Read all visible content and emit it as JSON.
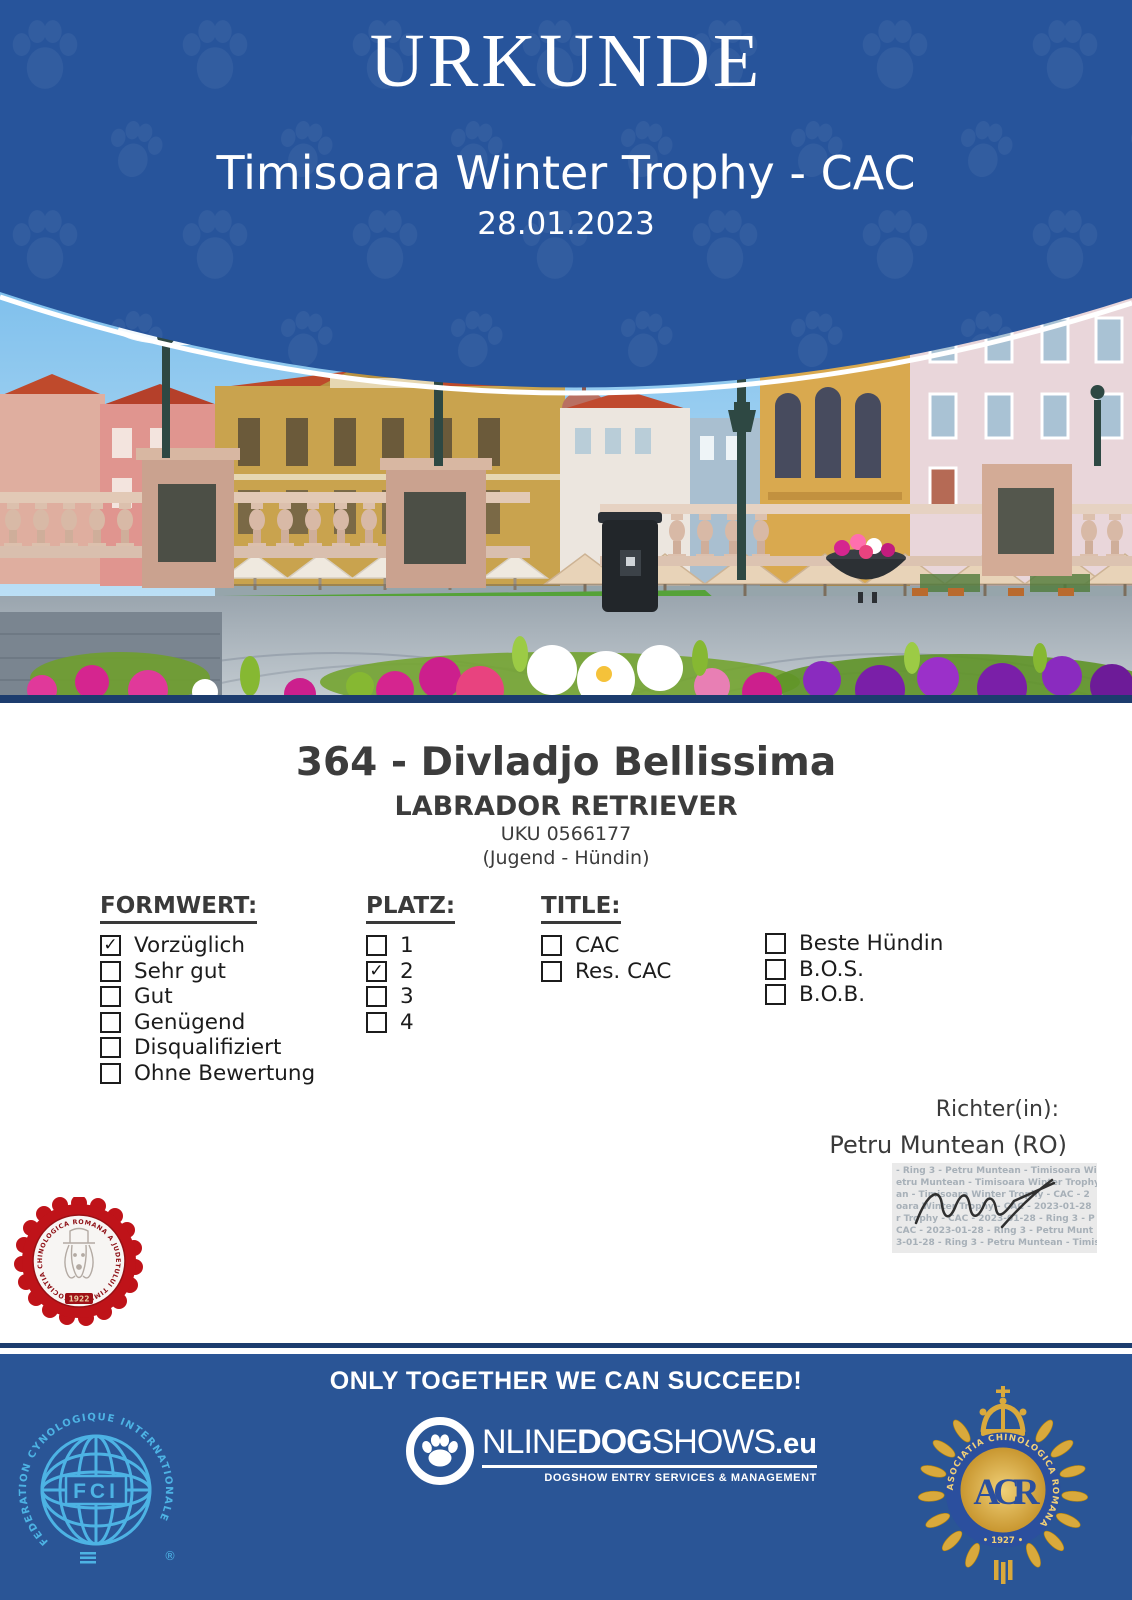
{
  "header": {
    "title": "URKUNDE",
    "event": "Timisoara Winter Trophy - CAC",
    "date": "28.01.2023"
  },
  "dog": {
    "title": "364 - Divladjo Bellissima",
    "breed": "LABRADOR RETRIEVER",
    "reg": "UKU 0566177",
    "class": "(Jugend - Hündin)"
  },
  "form": {
    "formwert": {
      "label": "FORMWERT:",
      "items": [
        {
          "label": "Vorzüglich",
          "checked": true,
          "mark": "✓"
        },
        {
          "label": "Sehr gut",
          "checked": false,
          "mark": ""
        },
        {
          "label": "Gut",
          "checked": false,
          "mark": ""
        },
        {
          "label": "Genügend",
          "checked": false,
          "mark": ""
        },
        {
          "label": "Disqualifiziert",
          "checked": false,
          "mark": ""
        },
        {
          "label": "Ohne Bewertung",
          "checked": false,
          "mark": ""
        }
      ]
    },
    "platz": {
      "label": "PLATZ:",
      "items": [
        {
          "label": "1",
          "checked": false,
          "mark": ""
        },
        {
          "label": "2",
          "checked": true,
          "mark": "✓"
        },
        {
          "label": "3",
          "checked": false,
          "mark": ""
        },
        {
          "label": "4",
          "checked": false,
          "mark": ""
        }
      ]
    },
    "title": {
      "label": "TITLE:",
      "items": [
        {
          "label": "CAC",
          "checked": false,
          "mark": ""
        },
        {
          "label": "Res. CAC",
          "checked": false,
          "mark": ""
        }
      ]
    },
    "extra": {
      "items": [
        {
          "label": "Beste Hündin",
          "checked": false,
          "mark": ""
        },
        {
          "label": "B.O.S.",
          "checked": false,
          "mark": ""
        },
        {
          "label": "B.O.B.",
          "checked": false,
          "mark": ""
        }
      ]
    }
  },
  "judge": {
    "label": "Richter(in):",
    "name": "Petru Muntean (RO)",
    "stamp_lines": [
      "- Ring 3 - Petru Muntean - Timisoara Wi",
      "etru Muntean - Timisoara Winter Trophy",
      "an - Timisoara Winter Trophy - CAC - 2",
      "oara Winter Trophy - CAC - 2023-01-28",
      "r Trophy - CAC - 2023-01-28 - Ring 3 - P",
      "CAC - 2023-01-28 - Ring 3 - Petru Munt",
      "3-01-28 - Ring 3 - Petru Muntean - Timis"
    ]
  },
  "seal": {
    "ring_text": "ASOCIATIA CHINOLOGICA ROMANA A JUDETULUI TIMIS",
    "year": "1922"
  },
  "footer": {
    "slogan": "ONLY TOGETHER WE CAN SUCCEED!",
    "fci": {
      "abbr": "FCI",
      "ring_text": "FEDERATION CYNOLOGIQUE INTERNATIONALE",
      "registered": "®"
    },
    "ods": {
      "o_rest": "NLINE",
      "dog": "DOG",
      "shows": "SHOWS",
      "eu": ".eu",
      "tagline": "DOGSHOW ENTRY SERVICES & MANAGEMENT"
    },
    "acr": {
      "ring_text": "ASOCIATIA CHINOLOGICA ROMANA",
      "year": "• 1927 •",
      "monogram": "ACR"
    }
  },
  "colors": {
    "header_blue": "#27549B",
    "footer_blue": "#2A5596",
    "navy_line": "#1C3C6E",
    "text_dark": "#3A3A3A",
    "seal_red": "#BF1319",
    "fci_blue": "#4DB3E4",
    "acr_gold": "#D9A93C"
  }
}
